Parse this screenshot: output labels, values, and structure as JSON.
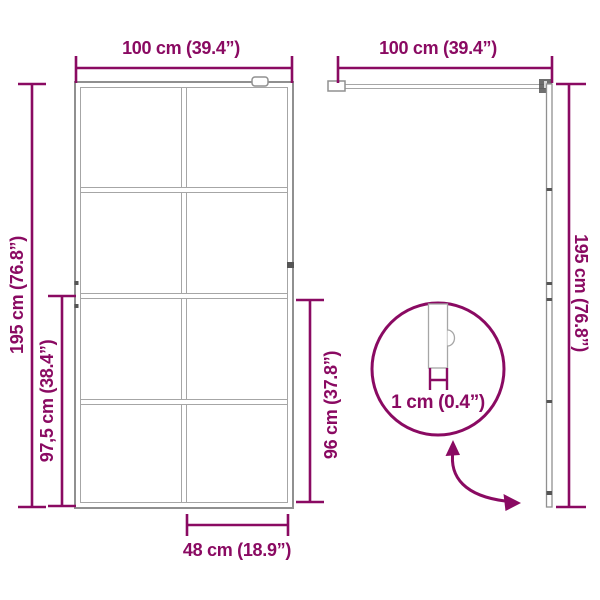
{
  "colors": {
    "accent": "#8a0a62",
    "frame_gray": "#909090"
  },
  "front_view": {
    "width_label": "100 cm (39.4”)",
    "height_label": "195 cm (76.8”)",
    "partial_height_label": "97,5 cm (38.4”)",
    "glass_height_label": "96 cm (37.8”)",
    "glass_width_label": "48 cm (18.9”)"
  },
  "side_view": {
    "width_label": "100 cm (39.4”)",
    "height_label": "195 cm (76.8”)"
  },
  "detail_view": {
    "thickness_label": "1 cm (0.4”)"
  }
}
